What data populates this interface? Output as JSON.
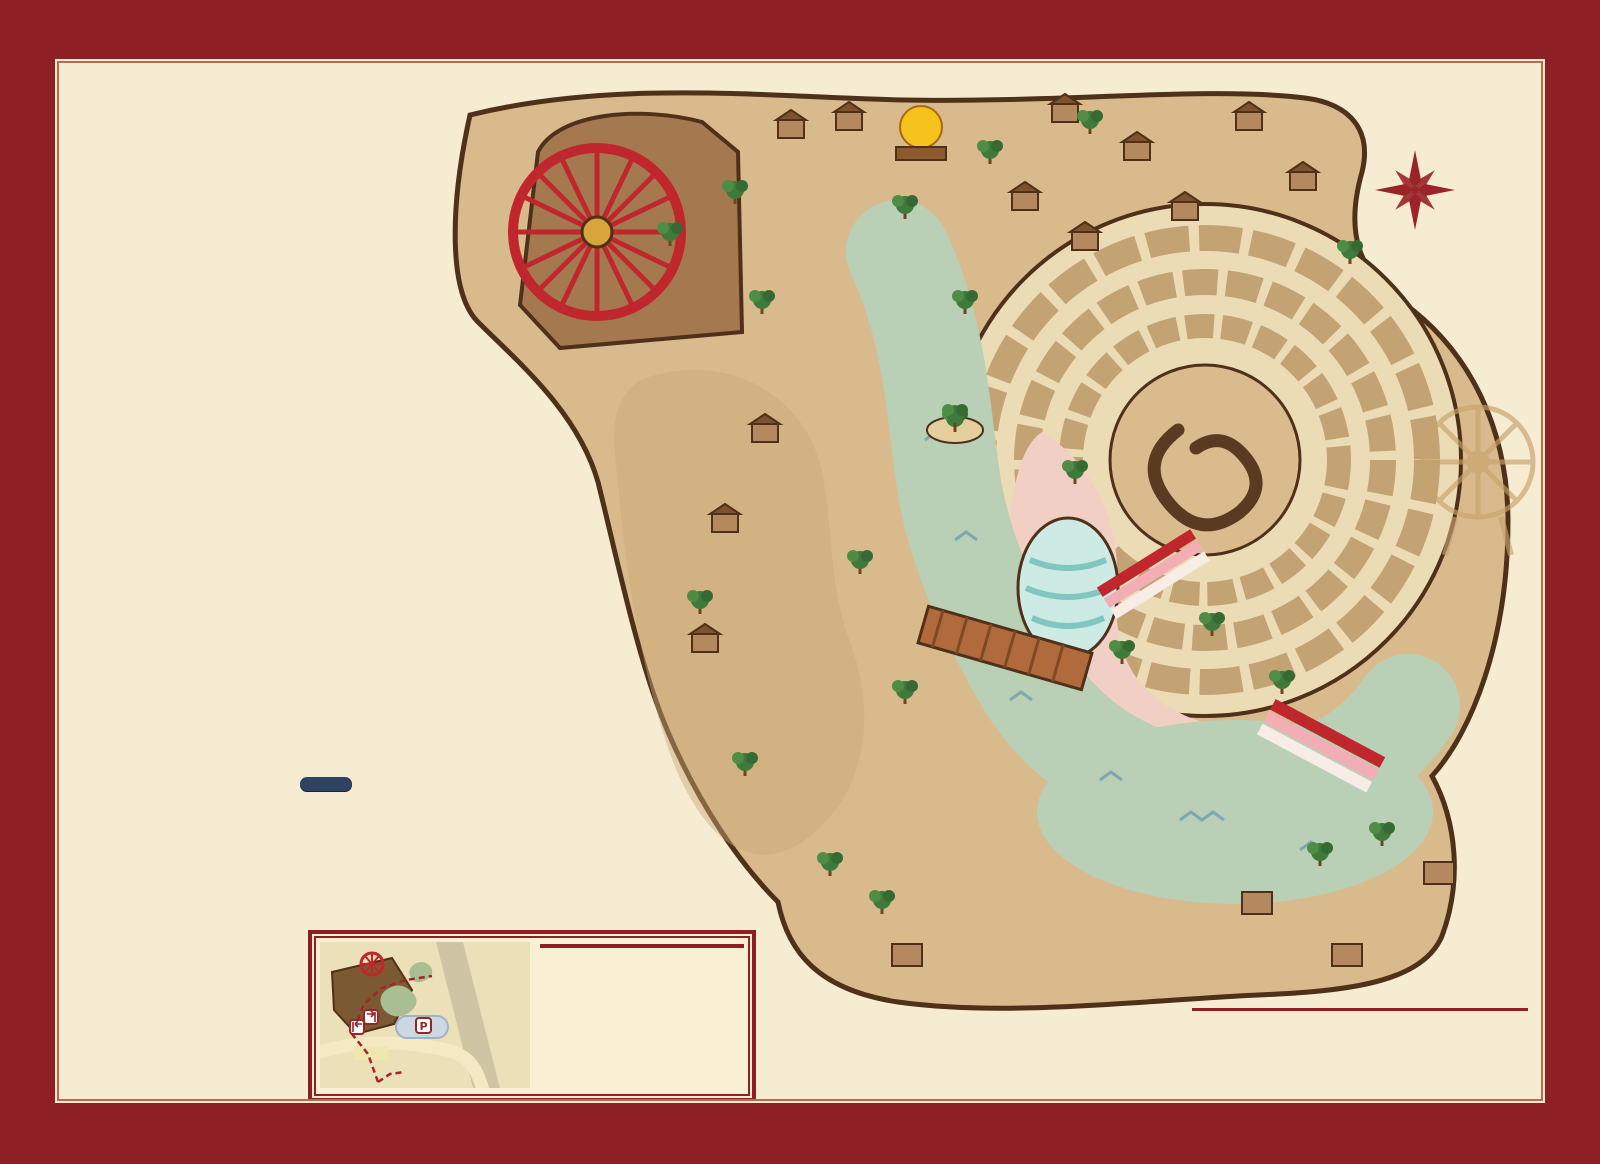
{
  "title": {
    "line1": "心动时",
    "line2": "看见三亚",
    "sub": "See San Ya"
  },
  "npc_tag": "NPC",
  "legend_columns": [
    [
      {
        "name": "首长部",
        "icon": "chief-icon",
        "items": [
          {
            "n": "1",
            "label": "万象迎宾/三月三盛会"
          }
        ]
      },
      {
        "name": "神遗部",
        "icon": "relic-tree-icon",
        "items": [
          {
            "n": "2",
            "label": "海神遗祭"
          },
          {
            "n": "3",
            "label": "苏轼的吐槽大会",
            "npc": "苏轼、禾苗"
          },
          {
            "n": "4",
            "label": "真爱同心箭",
            "npc": "鹿女、帕曼"
          },
          {
            "n": "5",
            "label": "梦幻水舞秀"
          },
          {
            "n": "6",
            "label": "天运争锋",
            "npc": "大总管福临"
          },
          {
            "n": "7",
            "label": "海瑞断案处",
            "npc": "海瑞"
          },
          {
            "n": "8",
            "label": "姻缘红线牵",
            "npc": "甘弓娘"
          }
        ]
      },
      {
        "name": "黎母部",
        "icon": "bird-icon",
        "items": [
          {
            "n": "9",
            "label": "红鸾心动",
            "npc": "喜娘、喜神"
          },
          {
            "n": "10",
            "label": "魔偶传递",
            "npc": "咒偶师"
          },
          {
            "n": "11",
            "label": "鼓祭掌合"
          },
          {
            "n": "12",
            "label": "心藤蔓延",
            "npc": "藤神"
          },
          {
            "n": "13",
            "label": "爱情魔法",
            "npc": "魔术师"
          },
          {
            "n": "14",
            "label": "聚英堂点兵",
            "npc": "冼夫人"
          },
          {
            "n": "15",
            "label": "巧手识纹",
            "npc": "黄道婆"
          }
        ]
      },
      {
        "name": "神缘部",
        "icon": "dancers-icon",
        "items": [
          {
            "n": "16",
            "label": "山海黎歌"
          }
        ]
      },
      {
        "name": "力神部",
        "icon": "strongman-icon",
        "items": [
          {
            "n": "17",
            "label": "神力试炼",
            "npc": "大力神"
          },
          {
            "n": "18",
            "label": "海棠喜事"
          },
          {
            "n": "19",
            "label": "黎乡笠影"
          },
          {
            "n": "20",
            "label": "山海黎韵"
          },
          {
            "n": "21",
            "label": "游客NPC才艺秀"
          }
        ]
      }
    ],
    [
      {
        "name": "野人部",
        "icon": "wildman-icon",
        "items": [
          {
            "n": "22",
            "label": "拳定良缘",
            "npc": "阿黎娜、鹿卡"
          },
          {
            "n": "23",
            "label": "刀山火海"
          },
          {
            "n": "24",
            "label": "篝火晚会"
          }
        ]
      },
      {
        "name": "餐饮部",
        "icon": "sun-eye-icon",
        "items": [
          {
            "n": "25",
            "label": "闻香识爱",
            "npc": "花神"
          },
          {
            "n": "26",
            "label": "土味情话王",
            "npc": "阿土哥"
          },
          {
            "n": "27",
            "label": "情酿换言",
            "npc": "茶满溢、心酿先生"
          },
          {
            "n": "28",
            "label": "南海引灯"
          },
          {
            "n": "29",
            "label": "甘工回首",
            "npc": "木灵—甘工"
          },
          {
            "n": "30",
            "label": "椰岛说书",
            "npc": "浪花妹"
          },
          {
            "n": "31",
            "label": "瞬影成画",
            "npc": "墨灵—阿染"
          },
          {
            "n": "32",
            "label": "岭南傩戏"
          }
        ]
      },
      {
        "name": "灵鹿部",
        "icon": "antler-icon",
        "items": [
          {
            "n": "33",
            "label": "《火吻海之灵鹿》"
          }
        ]
      }
    ],
    [
      {
        "name": "海灵部",
        "icon": "fish-icon",
        "items": [
          {
            "n": "34",
            "label": "三亚爱情艺术区"
          }
        ]
      },
      {
        "name": "沙盟部",
        "icon": "spiral-sun-icon",
        "items": [
          {
            "n": "35",
            "label": "沙印寻踪",
            "npc": "沙言、沙语"
          },
          {
            "n": "36",
            "label": "云音接力",
            "npc": "云歌、云瑶"
          },
          {
            "n": "37",
            "label": "爱与力量的试炼",
            "npc": "刚哥"
          },
          {
            "n": "38",
            "label": "梦幻水舞秀"
          },
          {
            "n": "39",
            "label": "灵鹿踏歌"
          }
        ]
      }
    ]
  ],
  "shops": {
    "title": "必逛商铺",
    "columns": [
      [
        {
          "n": "40",
          "label": "遇见·旅拍馆"
        },
        {
          "n": "41",
          "label": "海南阿卡阁非遗文创"
        },
        {
          "n": "42",
          "label": "宁夏老酸奶"
        },
        {
          "n": "43",
          "label": "看见三亚·文创馆"
        }
      ],
      [
        {
          "n": "44",
          "label": "鼓动人生"
        },
        {
          "n": "45",
          "label": "木亦乐乎 木工坊"
        },
        {
          "n": "46",
          "label": "手工牛肉肠"
        },
        {
          "n": "47",
          "label": "宁夏特色面馆"
        }
      ],
      [
        {
          "n": "48",
          "label": "穆苏阳·宁夏滩羊烧烤"
        },
        {
          "n": "49",
          "label": "小瀑布·手打酸辣粉"
        },
        {
          "n": "50",
          "label": "中宁枸杞·原浆铺子"
        },
        {
          "n": "51",
          "label": "小甜水供应社"
        }
      ]
    ]
  },
  "map": {
    "badges": [
      {
        "t": "神缘部",
        "icon": "dancers-icon",
        "x": 563,
        "y": 303
      },
      {
        "t": "力神部",
        "icon": "strongman-icon",
        "x": 800,
        "y": 213
      },
      {
        "t": "野人部",
        "icon": "wildman-icon",
        "x": 1233,
        "y": 158
      },
      {
        "t": "黎母部",
        "icon": "bird-icon",
        "x": 770,
        "y": 390
      },
      {
        "t": "餐饮部",
        "icon": "sun-eye-icon",
        "x": 1108,
        "y": 356
      },
      {
        "t": "沙盟部",
        "icon": "spiral-sun-icon",
        "x": 1112,
        "y": 546
      },
      {
        "t": "灵鹿部",
        "icon": "antler-icon",
        "x": 1302,
        "y": 612
      },
      {
        "t": "神遗部",
        "icon": "relic-tree-icon",
        "x": 874,
        "y": 797
      },
      {
        "t": "首长部",
        "icon": "chief-icon",
        "x": 1033,
        "y": 930
      },
      {
        "t": "海灵部",
        "icon": "fish-icon",
        "x": 1360,
        "y": 900
      }
    ],
    "labels": [
      {
        "t": "万象台",
        "x": 800,
        "y": 165,
        "n": "17 - 18 - 19 - 20",
        "npos": "above"
      },
      {
        "t": "日出日落",
        "x": 901,
        "y": 160
      },
      {
        "t": "洪荒角斗场",
        "x": 1249,
        "y": 192,
        "n": "22",
        "npos": "below"
      },
      {
        "t": "黎韵秀场",
        "x": 846,
        "y": 257,
        "n": "21",
        "npos": "above"
      },
      {
        "t": "阿土的情话场",
        "x": 962,
        "y": 230,
        "n": "26",
        "npos": "above"
      },
      {
        "t": "花韵识爱台",
        "x": 916,
        "y": 267,
        "n": "25",
        "npos": "above"
      },
      {
        "t": "情话换酒坊",
        "x": 1158,
        "y": 247,
        "n": "27",
        "npos": "below"
      },
      {
        "t": "刀山火海",
        "x": 1206,
        "y": 278,
        "n": "23",
        "npos": "left"
      },
      {
        "t": "巾帼聚英堂",
        "x": 816,
        "y": 302,
        "n": "14",
        "npos": "below"
      },
      {
        "t": "古傩台",
        "x": 953,
        "y": 318,
        "n": "32",
        "npos": "above"
      },
      {
        "t": "潭门舟渡",
        "x": 1118,
        "y": 312,
        "n": "28",
        "npos": "below"
      },
      {
        "t": "魔力奇缘台",
        "x": 828,
        "y": 340,
        "n": "13",
        "npos": "below"
      },
      {
        "t": "天涯书场",
        "x": 998,
        "y": 353,
        "n": "30",
        "npos": "above"
      },
      {
        "t": "黎锦问织坊",
        "x": 757,
        "y": 353
      },
      {
        "t": "山海黎歌",
        "x": 650,
        "y": 270,
        "n": "16",
        "npos": "below"
      },
      {
        "t": "青藤灵",
        "x": 644,
        "y": 392,
        "n": "12",
        "npos": "below"
      },
      {
        "t": "铃音台",
        "x": 690,
        "y": 483,
        "n": "11",
        "npos": "above"
      },
      {
        "t": "缘神魔力台",
        "x": 790,
        "y": 512,
        "n": "9",
        "npos": "above"
      },
      {
        "t": "天运坊",
        "x": 868,
        "y": 492,
        "n": "6",
        "npos": "below"
      },
      {
        "t": "甘工神木苑",
        "x": 1092,
        "y": 423,
        "n": "29",
        "npos": "above"
      },
      {
        "t": "火吻海之灵鹿舞台",
        "x": 1276,
        "y": 460,
        "n": "33",
        "npos": "below"
      },
      {
        "t": "灵契台",
        "x": 718,
        "y": 549,
        "n": "10",
        "npos": "below"
      },
      {
        "t": "红线鹊音阁",
        "x": 806,
        "y": 593,
        "n": "8",
        "npos": "below"
      },
      {
        "t": "游客NPC服务中心",
        "x": 957,
        "y": 598
      },
      {
        "t": "珠影舞境",
        "x": 1112,
        "y": 585
      },
      {
        "t": "水舞流光台",
        "x": 908,
        "y": 641,
        "n": "5",
        "npos": "above"
      },
      {
        "t": "三生桥",
        "x": 1012,
        "y": 628
      },
      {
        "t": "云霓音域",
        "x": 1170,
        "y": 664
      },
      {
        "t": "同心靶场",
        "x": 845,
        "y": 683,
        "n": "4",
        "npos": "above"
      },
      {
        "t": "海瑞断案处",
        "x": 748,
        "y": 694,
        "n": "7",
        "npos": "below"
      },
      {
        "t": "刚的堡",
        "x": 1160,
        "y": 714,
        "n": "37",
        "npos": "below"
      },
      {
        "t": "海神滩",
        "x": 874,
        "y": 747,
        "n": "2",
        "npos": "right"
      },
      {
        "t": "千里诗词林",
        "x": 772,
        "y": 758,
        "n": "3",
        "npos": "below"
      },
      {
        "t": "三月三广场",
        "x": 888,
        "y": 958,
        "n": "1",
        "npos": "above"
      }
    ],
    "markers": [
      {
        "n": "49",
        "x": 1044,
        "y": 146,
        "c": "blue"
      },
      {
        "n": "48",
        "x": 972,
        "y": 252,
        "c": "blue"
      },
      {
        "n": "47",
        "x": 1021,
        "y": 286,
        "c": "blue"
      },
      {
        "n": "31",
        "x": 1053,
        "y": 293,
        "c": "blue"
      },
      {
        "n": "50",
        "x": 1146,
        "y": 261,
        "c": "blue"
      },
      {
        "n": "24",
        "x": 1232,
        "y": 247,
        "c": "red"
      },
      {
        "n": "45",
        "x": 789,
        "y": 434,
        "c": "blue"
      },
      {
        "n": "46",
        "x": 878,
        "y": 451,
        "c": "blue"
      },
      {
        "n": "35",
        "x": 1095,
        "y": 494,
        "c": "red"
      },
      {
        "n": "38",
        "x": 1096,
        "y": 564,
        "c": "red"
      },
      {
        "n": "39",
        "x": 1096,
        "y": 626,
        "c": "red"
      },
      {
        "n": "44",
        "x": 734,
        "y": 650,
        "c": "blue"
      },
      {
        "n": "42",
        "x": 883,
        "y": 688,
        "c": "blue"
      },
      {
        "n": "43",
        "x": 828,
        "y": 706,
        "c": "blue"
      },
      {
        "n": "15",
        "x": 965,
        "y": 724,
        "c": "red"
      },
      {
        "n": "41",
        "x": 974,
        "y": 741,
        "c": "blue"
      },
      {
        "n": "36",
        "x": 1180,
        "y": 699,
        "c": "red"
      },
      {
        "n": "40",
        "x": 1092,
        "y": 869,
        "c": "blue"
      },
      {
        "n": "51",
        "x": 1422,
        "y": 811,
        "c": "blue"
      },
      {
        "n": "34",
        "x": 1420,
        "y": 870,
        "c": "red"
      }
    ],
    "gates": [
      {
        "label": "入口",
        "x": 1148,
        "y": 1012
      },
      {
        "label": "出口",
        "x": 1477,
        "y": 986
      }
    ],
    "icons": [
      {
        "type": "toilet-icon",
        "x": 745,
        "y": 166
      },
      {
        "type": "toilet-icon",
        "x": 751,
        "y": 288
      },
      {
        "type": "toilet-icon",
        "x": 1330,
        "y": 258
      },
      {
        "type": "toilet-icon",
        "x": 888,
        "y": 726
      },
      {
        "type": "toilet-icon",
        "x": 1025,
        "y": 842
      },
      {
        "type": "info-icon",
        "x": 1267,
        "y": 920
      },
      {
        "type": "runner-icon",
        "x": 580,
        "y": 378
      },
      {
        "type": "runner-icon",
        "x": 1392,
        "y": 293
      },
      {
        "type": "runner-icon",
        "x": 1034,
        "y": 1006
      },
      {
        "type": "runner-icon",
        "x": 1165,
        "y": 958
      },
      {
        "type": "park-entrance-icon",
        "x": 1190,
        "y": 975
      },
      {
        "type": "park-exit-icon",
        "x": 1459,
        "y": 935
      }
    ],
    "compass": {
      "west": "西",
      "south": "南",
      "north": "北",
      "east": "东"
    }
  },
  "gate_guide": {
    "title": "出入口指引图",
    "road_label": "海棠南路",
    "items": [
      {
        "icon": "parking-icon",
        "glyph": "P",
        "label": "停车场",
        "en": "Parking Space"
      },
      {
        "icon": "park-entrance-icon",
        "label": "园区入口",
        "en": "Park Entrance"
      },
      {
        "icon": "route-dash-icon",
        "label": "路线",
        "en": ""
      },
      {
        "icon": "park-exit-icon",
        "label": "园区出口",
        "en": "Export Of Park"
      },
      {
        "icon": "swatch-brown",
        "swatch": "#8a6b3e",
        "label": "看见三亚",
        "en": ""
      },
      {
        "icon": "swatch-beige",
        "swatch": "#e9d9ae",
        "label": "海昌",
        "en": ""
      }
    ]
  },
  "services_legend": [
    {
      "icon": "info-icon",
      "label": "游客服务中心",
      "en": "Service Center For Tourists"
    },
    {
      "icon": "park-entrance-icon",
      "label": "园区入口",
      "en": "Park Entrance"
    },
    {
      "icon": "park-exit-icon",
      "label": "园区出口",
      "en": "Export Of Park"
    },
    {
      "icon": "runner-icon",
      "label": "疏散通道",
      "en": "Evacuation Routes"
    },
    {
      "icon": "service-station-icon",
      "label": "服务站",
      "en": "Services Sites"
    },
    {
      "icon": "toilet-icon",
      "label": "卫生间",
      "en": "Ticket Office"
    }
  ],
  "decor": {
    "glyphs": "◆ ○ ▲ □ ◇ △ ■ ○ ◆ □ ▲ ◇ ○ ■ △ ◆ □ ○ ▲ ◇ ■ ○ ◆ △ □ ◇ ▲ ○ ■ ◆"
  }
}
